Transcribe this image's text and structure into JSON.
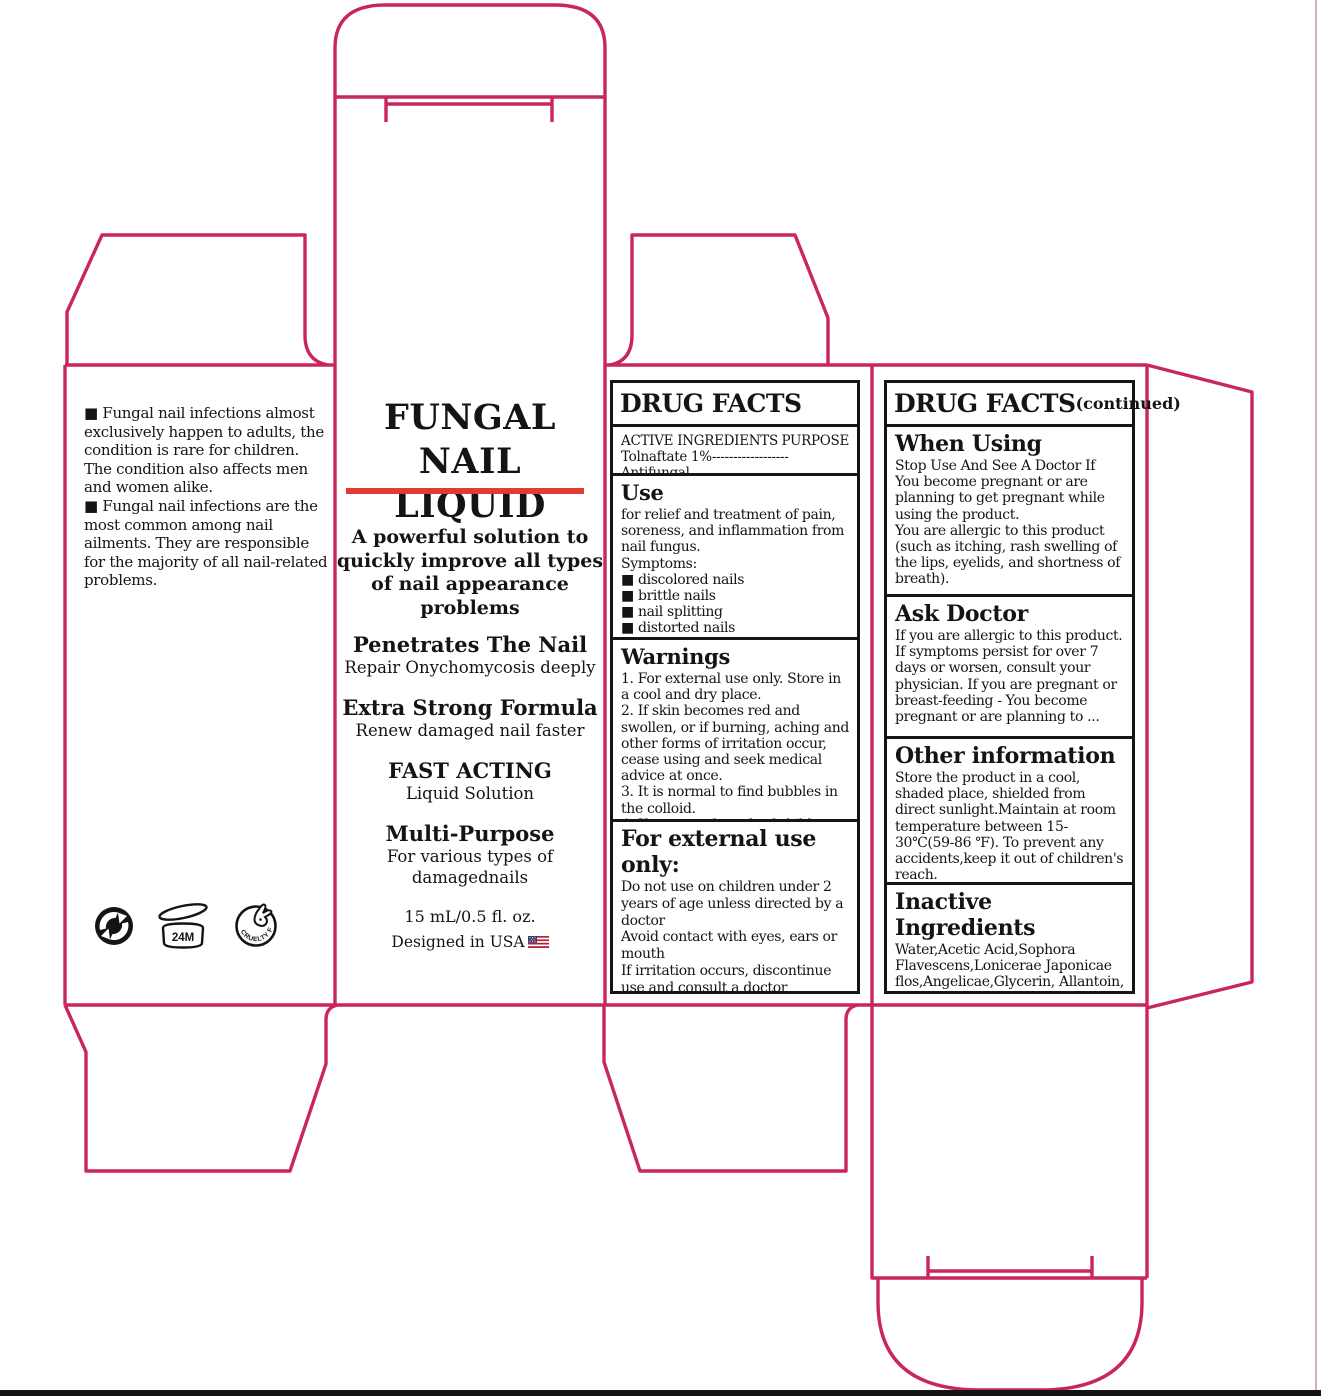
{
  "colors": {
    "dieline": "#C9255E",
    "accent_red": "#E23B34",
    "ink": "#141414"
  },
  "left_panel": {
    "info_text": "■ Fungal nail infections almost exclusively happen to adults, the condition is rare for children. The condition also affects men and women alike.\n■ Fungal nail infections are the most common among nail ailments. They are responsible for the majority of all nail-related problems.",
    "period_after_opening": "24M",
    "cruelty_free": "CRUELTY FREE"
  },
  "front_panel": {
    "title": "FUNGAL NAIL\nLIQUID",
    "tagline": "A powerful solution to quickly improve all types of nail appearance problems",
    "features": [
      {
        "heading": "Penetrates The Nail",
        "sub": "Repair Onychomycosis deeply"
      },
      {
        "heading": "Extra Strong Formula",
        "sub": "Renew damaged nail faster"
      },
      {
        "heading": "FAST ACTING",
        "sub": "Liquid Solution"
      },
      {
        "heading": "Multi-Purpose",
        "sub": "For various types of damagednails"
      }
    ],
    "volume": "15 mL/0.5 fl. oz.",
    "origin": "Designed in USA"
  },
  "drug_facts": {
    "title": "DRUG FACTS",
    "active_ingredients_label": "ACTIVE INGREDIENTS",
    "purpose_label": "PURPOSE",
    "active_ingredient_line": "Tolnaftate 1%------------------Antifungal",
    "use": {
      "heading": "Use",
      "body": "for relief and treatment of pain, soreness, and inflammation from nail fungus.\nSymptoms:",
      "symptoms": "■ discolored nails\n■ brittle nails\n■ nail splitting\n■ distorted nails"
    },
    "warnings": {
      "heading": "Warnings",
      "body": "1. For external use only. Store in a cool and dry place.\n2. If skin becomes red and swollen, or if burning, aching and other forms of irritation occur, cease using and seek medical advice at once.\n3. It is normal to find bubbles in the colloid.\n4. Keep out of reach of children."
    },
    "external_use": {
      "heading": "For external use only:",
      "body": "Do not use on children under 2 years of age unless directed by a doctor\nAvoid contact with eyes, ears or mouth\nIf irritation occurs, discontinue use and consult a doctor\nIf swallowed, get medical help or consult a poison control center immediately."
    }
  },
  "drug_facts_continued": {
    "title": "DRUG FACTS",
    "title_suffix": "(continued)",
    "when_using": {
      "heading": "When Using",
      "body": "Stop Use And See A Doctor If\nYou become pregnant or are planning to get pregnant while using the product.\nYou are allergic to this product (such as itching, rash swelling of the lips, eyelids, and shortness of breath)."
    },
    "ask_doctor": {
      "heading": "Ask Doctor",
      "body": "If you are allergic to this product. If symptoms persist for over 7 days or worsen, consult your physician. If you are pregnant or breast-feeding - You become pregnant or are planning to ..."
    },
    "other_information": {
      "heading": "Other information",
      "body": "Store the product in a cool, shaded place, shielded from direct sunlight.Maintain at room temperature between 15-30℃(59-86 ℉). To prevent any accidents,keep it out of children's reach."
    },
    "inactive_ingredients": {
      "heading": "Inactive Ingredients",
      "body": "Water,Acetic Acid,Sophora Flavescens,Lonicerae Japonicae flos,Angelicae,Glycerin, Allantoin, Garlic Extract, Tea Tree Oi"
    }
  }
}
